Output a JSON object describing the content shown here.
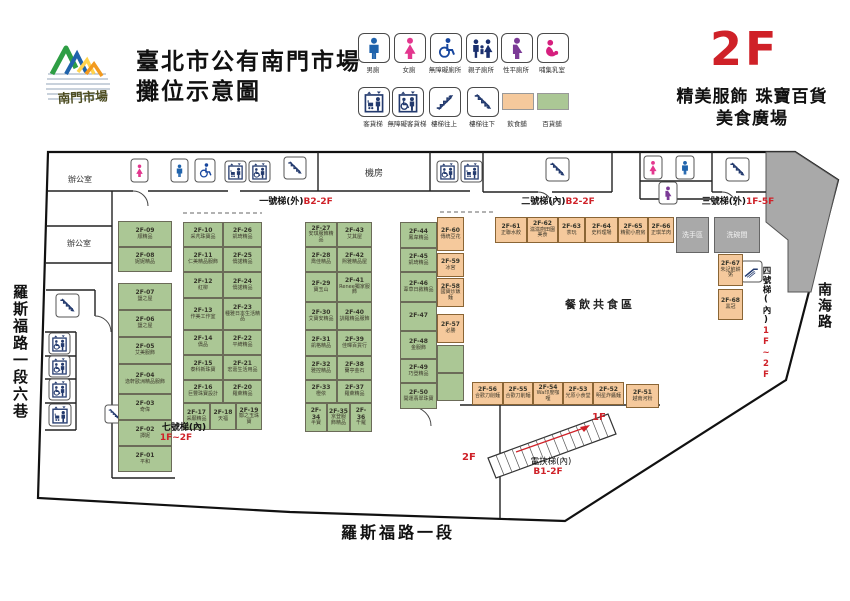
{
  "header": {
    "logo_text": "南門市場",
    "title_line1": "臺北市公有南門市場",
    "title_line2": "攤位示意圖",
    "floor": "2F",
    "floor_desc1": "精美服飾 珠寶百貨",
    "floor_desc2": "美食廣場"
  },
  "colors": {
    "food": "#f5c99c",
    "retail": "#abc795",
    "accent": "#cf2128",
    "room_gray": "#a9a9a9"
  },
  "legend": {
    "row1": [
      {
        "icon": "male-toilet",
        "label": "男廁"
      },
      {
        "icon": "female-toilet",
        "label": "女廁"
      },
      {
        "icon": "accessible-toilet",
        "label": "無障礙廁所"
      },
      {
        "icon": "family-toilet",
        "label": "親子廁所"
      },
      {
        "icon": "all-gender-toilet",
        "label": "性平廁所"
      },
      {
        "icon": "nursing-room",
        "label": "哺集乳室"
      }
    ],
    "row2": [
      {
        "icon": "freight-elevator",
        "label": "客貨梯"
      },
      {
        "icon": "accessible-elevator",
        "label": "無障礙客貨梯"
      },
      {
        "icon": "stairs-up",
        "label": "樓梯往上"
      },
      {
        "icon": "stairs-down",
        "label": "樓梯往下"
      },
      {
        "icon": "dining-swatch",
        "label": "飲食舖"
      },
      {
        "icon": "retail-swatch",
        "label": "百貨舖"
      }
    ]
  },
  "map": {
    "rooms": {
      "office": "辦公室",
      "machine": "機房",
      "wash": "洗手區",
      "dishwash": "洗碗間",
      "dining": "餐飲共食區"
    },
    "stairs": [
      {
        "name": "一號梯(外)",
        "range": "B2-2F"
      },
      {
        "name": "二號梯(內)",
        "range": "B2-2F"
      },
      {
        "name": "三號梯(外)",
        "range": "1F-5F"
      },
      {
        "name": "四號梯(內)",
        "range": "1F~2F"
      },
      {
        "name": "七號梯(內)",
        "range": "1F~2F"
      },
      {
        "name": "電扶梯(內)",
        "range": "B1-2F"
      }
    ],
    "escalator_ends": {
      "top": "1F",
      "bottom": "2F"
    },
    "roads": {
      "left": "羅斯福路一段六巷",
      "right": "南海路",
      "bottom": "羅斯福路一段"
    },
    "icons": [
      "female-toilet",
      "male-toilet",
      "accessible-toilet",
      "freight-elevator",
      "accessible-elevator",
      "stairs-down",
      "accessible-elevator",
      "freight-elevator",
      "stairs-down",
      "female-toilet",
      "male-toilet",
      "all-gender-toilet",
      "stairs-down",
      "escalator",
      "stairs-down",
      "accessible-elevator",
      "accessible-elevator",
      "accessible-elevator",
      "freight-elevator",
      "stairs-down"
    ],
    "stalls": [
      {
        "id": "2F-01",
        "name": "平和",
        "type": "retail"
      },
      {
        "id": "2F-02",
        "name": "譚妮",
        "type": "retail"
      },
      {
        "id": "2F-03",
        "name": "奇偉",
        "type": "retail"
      },
      {
        "id": "2F-04",
        "name": "逸軒歐洲精品服飾",
        "type": "retail"
      },
      {
        "id": "2F-05",
        "name": "艾美服飾",
        "type": "retail"
      },
      {
        "id": "2F-06",
        "name": "鹽之屋",
        "type": "retail"
      },
      {
        "id": "2F-07",
        "name": "鹽之屋",
        "type": "retail"
      },
      {
        "id": "2F-08",
        "name": "妮妮精品",
        "type": "retail"
      },
      {
        "id": "2F-09",
        "name": "順精品",
        "type": "retail"
      },
      {
        "id": "2F-10",
        "name": "采芃珠寶品",
        "type": "retail"
      },
      {
        "id": "2F-11",
        "name": "仁美精品服飾",
        "type": "retail"
      },
      {
        "id": "2F-12",
        "name": "紅柳",
        "type": "retail"
      },
      {
        "id": "2F-13",
        "name": "作美工作室",
        "type": "retail"
      },
      {
        "id": "2F-14",
        "name": "僑品",
        "type": "retail"
      },
      {
        "id": "2F-15",
        "name": "泰科新珠寶",
        "type": "retail"
      },
      {
        "id": "2F-16",
        "name": "巨豐珠寶設計",
        "type": "retail"
      },
      {
        "id": "2F-17",
        "name": "采願精品",
        "type": "retail"
      },
      {
        "id": "2F-18",
        "name": "天福",
        "type": "retail"
      },
      {
        "id": "2F-19",
        "name": "鄒之玉珠寶",
        "type": "retail"
      },
      {
        "id": "2F-20",
        "name": "羅萊精品",
        "type": "retail"
      },
      {
        "id": "2F-21",
        "name": "宏嘉生活用品",
        "type": "retail"
      },
      {
        "id": "2F-22",
        "name": "平綺精品",
        "type": "retail"
      },
      {
        "id": "2F-23",
        "name": "種雅日本生活精品",
        "type": "retail"
      },
      {
        "id": "2F-24",
        "name": "僑諾精品",
        "type": "retail"
      },
      {
        "id": "2F-25",
        "name": "僑諾精品",
        "type": "retail"
      },
      {
        "id": "2F-26",
        "name": "凱琦精品",
        "type": "retail"
      },
      {
        "id": "2F-27",
        "name": "安琪服飾精品",
        "type": "retail"
      },
      {
        "id": "2F-28",
        "name": "喬佳精品",
        "type": "retail"
      },
      {
        "id": "2F-29",
        "name": "寶玉山",
        "type": "retail"
      },
      {
        "id": "2F-30",
        "name": "艾寶安精品",
        "type": "retail"
      },
      {
        "id": "2F-31",
        "name": "凱格精品",
        "type": "retail"
      },
      {
        "id": "2F-32",
        "name": "雅控精品",
        "type": "retail"
      },
      {
        "id": "2F-33",
        "name": "橙依",
        "type": "retail"
      },
      {
        "id": "2F-34",
        "name": "半寶",
        "type": "retail"
      },
      {
        "id": "2F-35",
        "name": "京登服飾精品",
        "type": "retail"
      },
      {
        "id": "2F-36",
        "name": "千羅",
        "type": "retail"
      },
      {
        "id": "2F-37",
        "name": "羅萊精品",
        "type": "retail"
      },
      {
        "id": "2F-38",
        "name": "蘭亭金石",
        "type": "retail"
      },
      {
        "id": "2F-39",
        "name": "佳暉百貨行",
        "type": "retail"
      },
      {
        "id": "2F-40",
        "name": "訓羅精品服飾",
        "type": "retail"
      },
      {
        "id": "2F-41",
        "name": "Renee獨家服飾",
        "type": "retail"
      },
      {
        "id": "2F-42",
        "name": "熙雅精品屋",
        "type": "retail"
      },
      {
        "id": "2F-43",
        "name": "艾其屋",
        "type": "retail"
      },
      {
        "id": "2F-44",
        "name": "鳳韋精品",
        "type": "retail"
      },
      {
        "id": "2F-45",
        "name": "凱琦精品",
        "type": "retail"
      },
      {
        "id": "2F-46",
        "name": "葦草日敘精品",
        "type": "retail"
      },
      {
        "id": "2F-47",
        "name": "",
        "type": "retail"
      },
      {
        "id": "2F-48",
        "name": "金服飾",
        "type": "retail"
      },
      {
        "id": "2F-49",
        "name": "巧登精品",
        "type": "retail"
      },
      {
        "id": "2F-50",
        "name": "開運翡翠珠寶",
        "type": "retail"
      },
      {
        "id": "2F-51",
        "name": "越南河粉",
        "type": "food"
      },
      {
        "id": "2F-52",
        "name": "明星炸醬麵",
        "type": "food"
      },
      {
        "id": "2F-53",
        "name": "光原小食堂",
        "type": "food"
      },
      {
        "id": "2F-54",
        "name": "Wa印度咖哩",
        "type": "food"
      },
      {
        "id": "2F-55",
        "name": "合歡刀削麵",
        "type": "food"
      },
      {
        "id": "2F-56",
        "name": "合歡刀削麵",
        "type": "food"
      },
      {
        "id": "2F-57",
        "name": "必勝",
        "type": "food"
      },
      {
        "id": "2F-58",
        "name": "國寶炒飯麵",
        "type": "food"
      },
      {
        "id": "2F-59",
        "name": "冰宮",
        "type": "food"
      },
      {
        "id": "2F-60",
        "name": "傳統豆花",
        "type": "food"
      },
      {
        "id": "2F-61",
        "name": "正聯水餃",
        "type": "food"
      },
      {
        "id": "2F-62",
        "name": "滋滋廚田園美食",
        "type": "food"
      },
      {
        "id": "2F-63",
        "name": "茶玩",
        "type": "food"
      },
      {
        "id": "2F-64",
        "name": "史料理場",
        "type": "food"
      },
      {
        "id": "2F-65",
        "name": "精勤小廚房",
        "type": "food"
      },
      {
        "id": "2F-66",
        "name": "正琪羊肉",
        "type": "food"
      },
      {
        "id": "2F-67",
        "name": "朱記餡餅粥",
        "type": "food"
      },
      {
        "id": "2F-68",
        "name": "黑冠",
        "type": "food"
      },
      {
        "id": "",
        "name": "",
        "type": "retail"
      },
      {
        "id": "",
        "name": "",
        "type": "retail"
      }
    ]
  }
}
